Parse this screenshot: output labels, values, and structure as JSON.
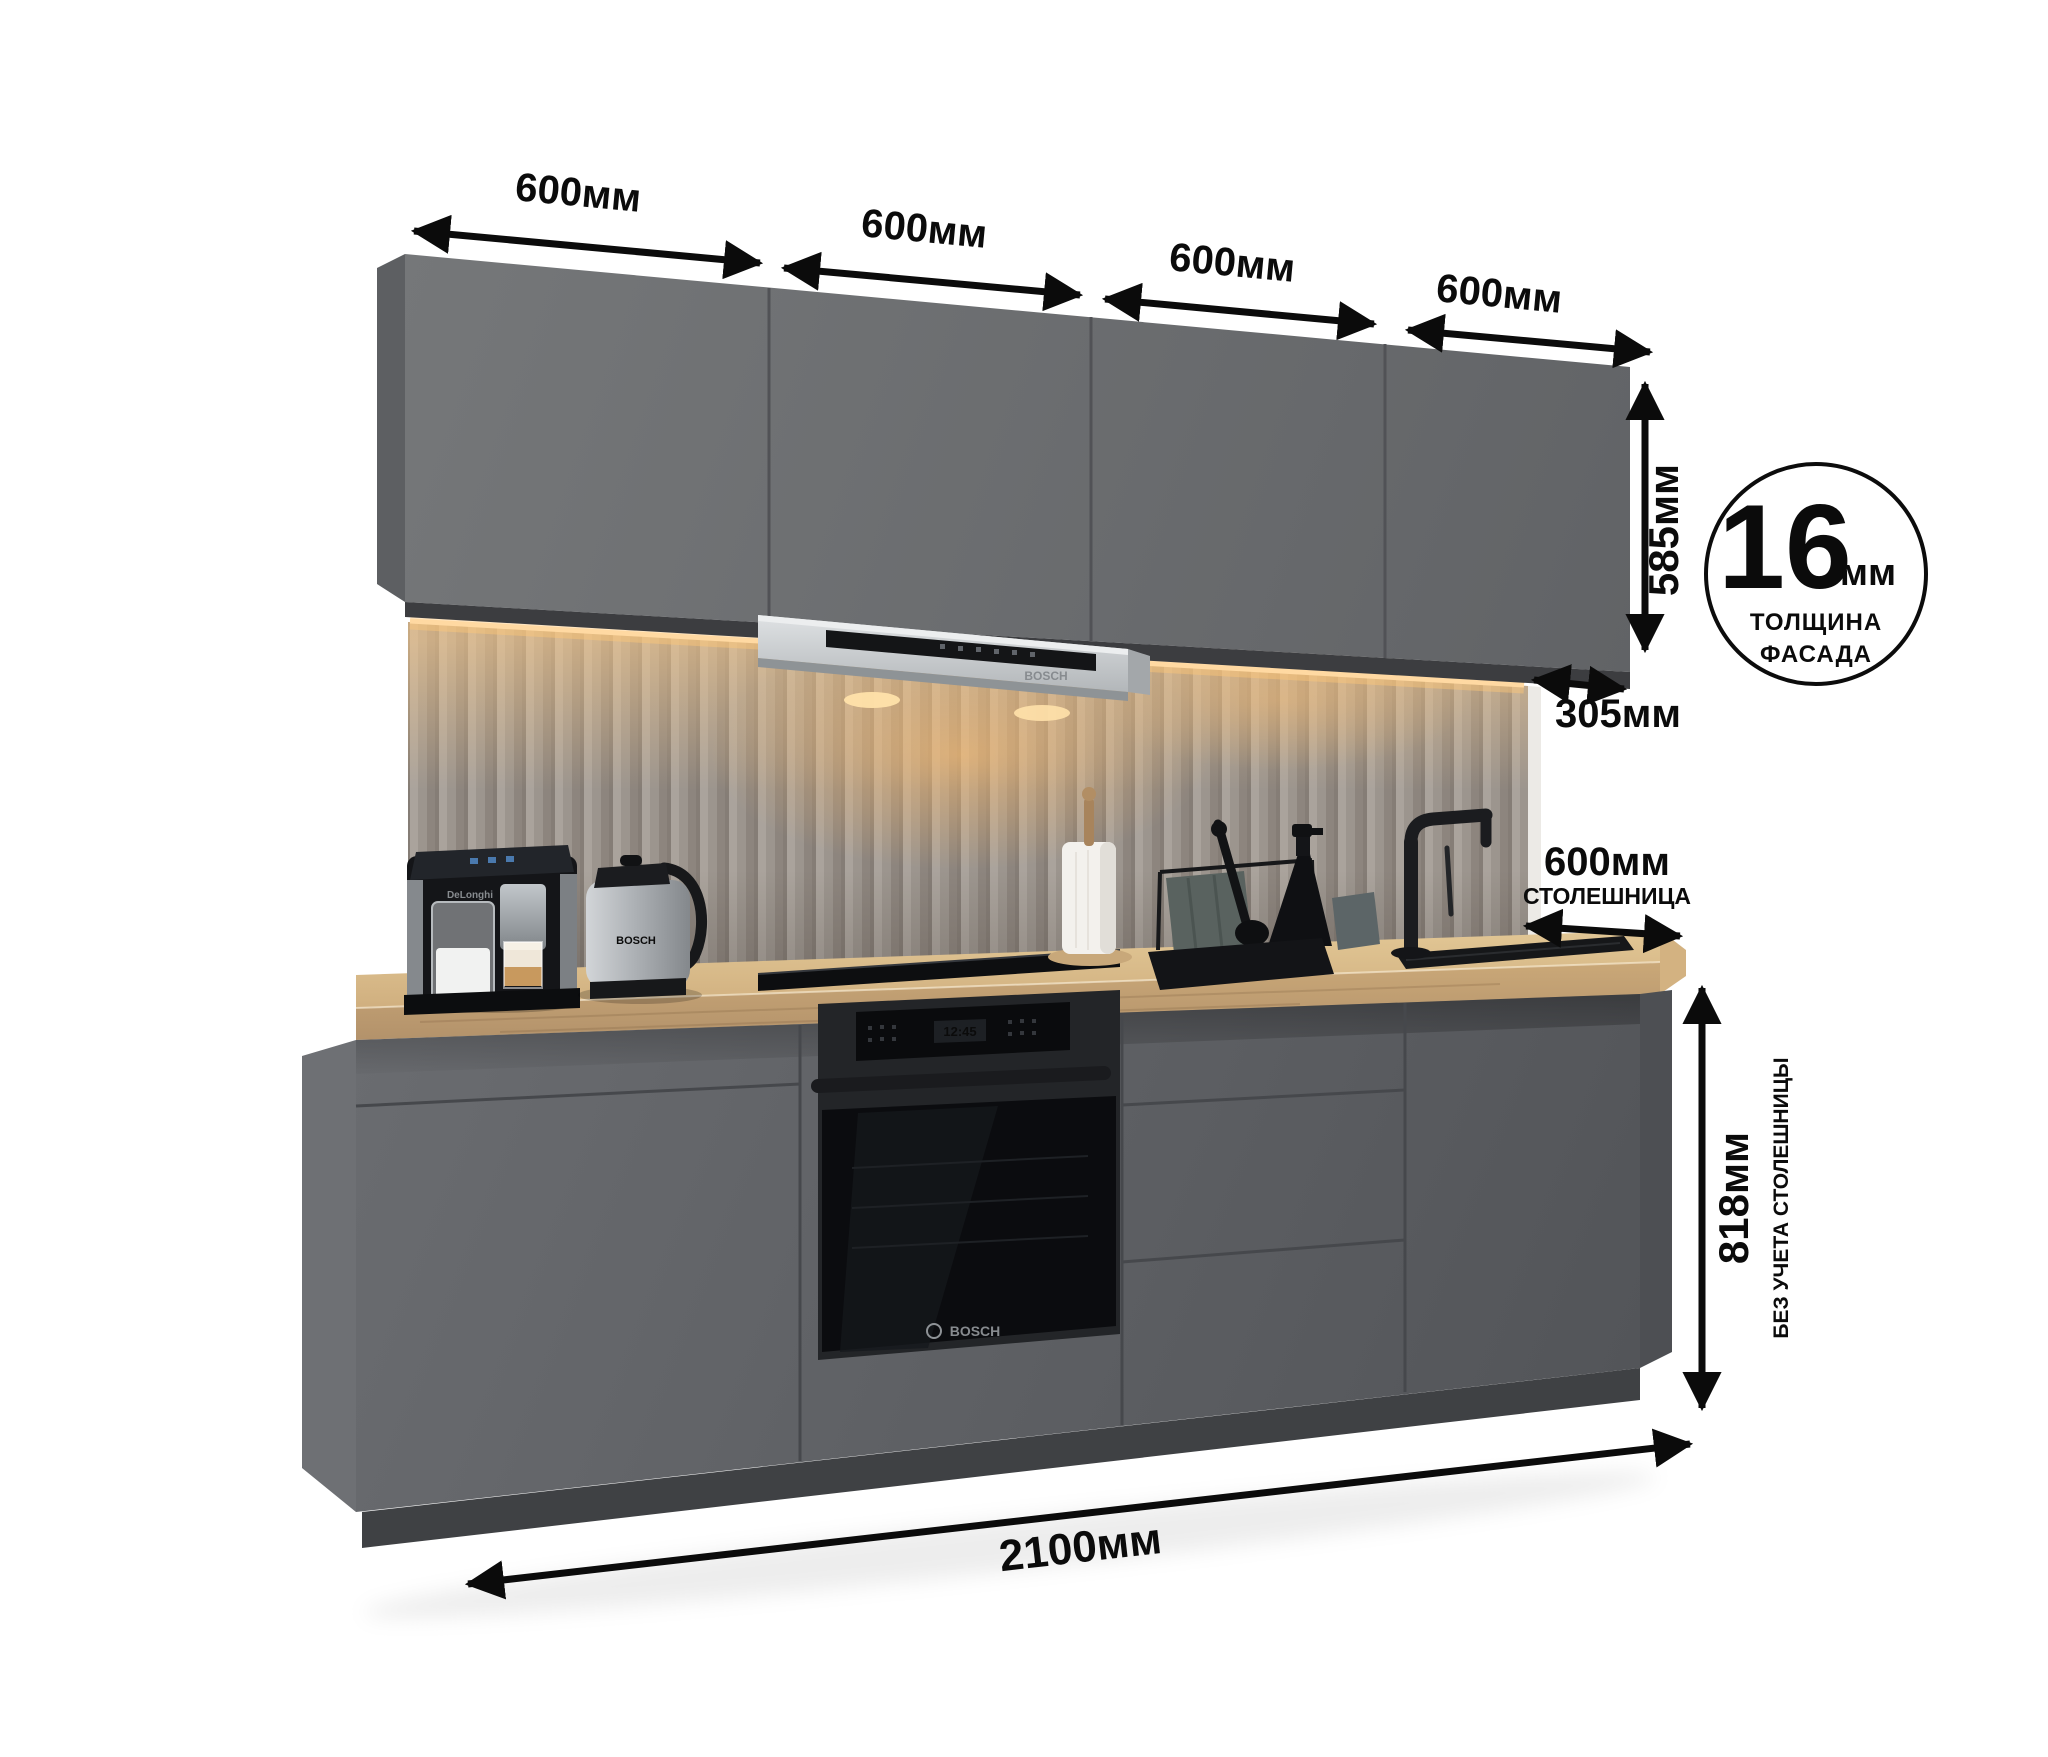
{
  "annotations": {
    "top_widths": [
      {
        "label": "600мм"
      },
      {
        "label": "600мм"
      },
      {
        "label": "600мм"
      },
      {
        "label": "600мм"
      }
    ],
    "upper_cabinet_height": "585мм",
    "upper_cabinet_depth": "305мм",
    "countertop_depth": "600мм",
    "countertop_depth_note": "СТОЛЕШНИЦА",
    "base_height": "818мм",
    "base_height_note": "БЕЗ УЧЕТА СТОЛЕШНИЦЫ",
    "total_width": "2100мм"
  },
  "badge": {
    "value": "16",
    "unit": "мм",
    "caption_line1": "ТОЛЩИНА",
    "caption_line2": "ФАСАДА"
  },
  "appliances": {
    "hood_brand": "BOSCH",
    "oven_brand": "BOSCH",
    "oven_clock": "12:45",
    "kettle_brand": "BOSCH",
    "coffee_machine_brand": "DeLonghi"
  },
  "colors": {
    "annotation": "#0b0b0b",
    "cabinet_front": "#6b6d70",
    "base_front": "#616367",
    "countertop_wood": "#d5b586",
    "backsplash": "#9b948d",
    "led_glow": "#f2c98d",
    "steel": "#c7cacd",
    "appliance_black": "#0c0d10",
    "background": "#ffffff"
  }
}
